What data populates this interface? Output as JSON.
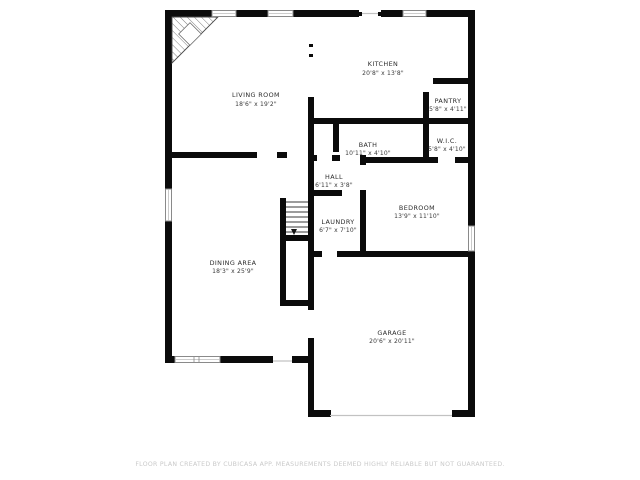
{
  "floor_plan": {
    "rooms": {
      "living": {
        "name": "LIVING ROOM",
        "dims": "18'6\" x 19'2\""
      },
      "kitchen": {
        "name": "KITCHEN",
        "dims": "20'8\" x 13'8\""
      },
      "pantry": {
        "name": "PANTRY",
        "dims": "5'8\" x 4'11\""
      },
      "bath": {
        "name": "BATH",
        "dims": "10'11\" x 4'10\""
      },
      "wic": {
        "name": "W.I.C.",
        "dims": "5'8\" x 4'10\""
      },
      "hall": {
        "name": "HALL",
        "dims": "6'11\" x 3'8\""
      },
      "laundry": {
        "name": "LAUNDRY",
        "dims": "6'7\" x 7'10\""
      },
      "bedroom": {
        "name": "BEDROOM",
        "dims": "13'9\" x 11'10\""
      },
      "dining": {
        "name": "DINING AREA",
        "dims": "18'3\" x 25'9\""
      },
      "garage": {
        "name": "GARAGE",
        "dims": "20'6\" x 20'11\""
      }
    },
    "disclaimer": "FLOOR PLAN CREATED BY CUBICASA APP. MEASUREMENTS DEEMED HIGHLY RELIABLE BUT NOT GUARANTEED.",
    "colors": {
      "wall": "#0b0b0b",
      "window_frame": "#8a8a8a",
      "disclaimer_text": "#c9c9c9",
      "background": "#ffffff"
    }
  }
}
